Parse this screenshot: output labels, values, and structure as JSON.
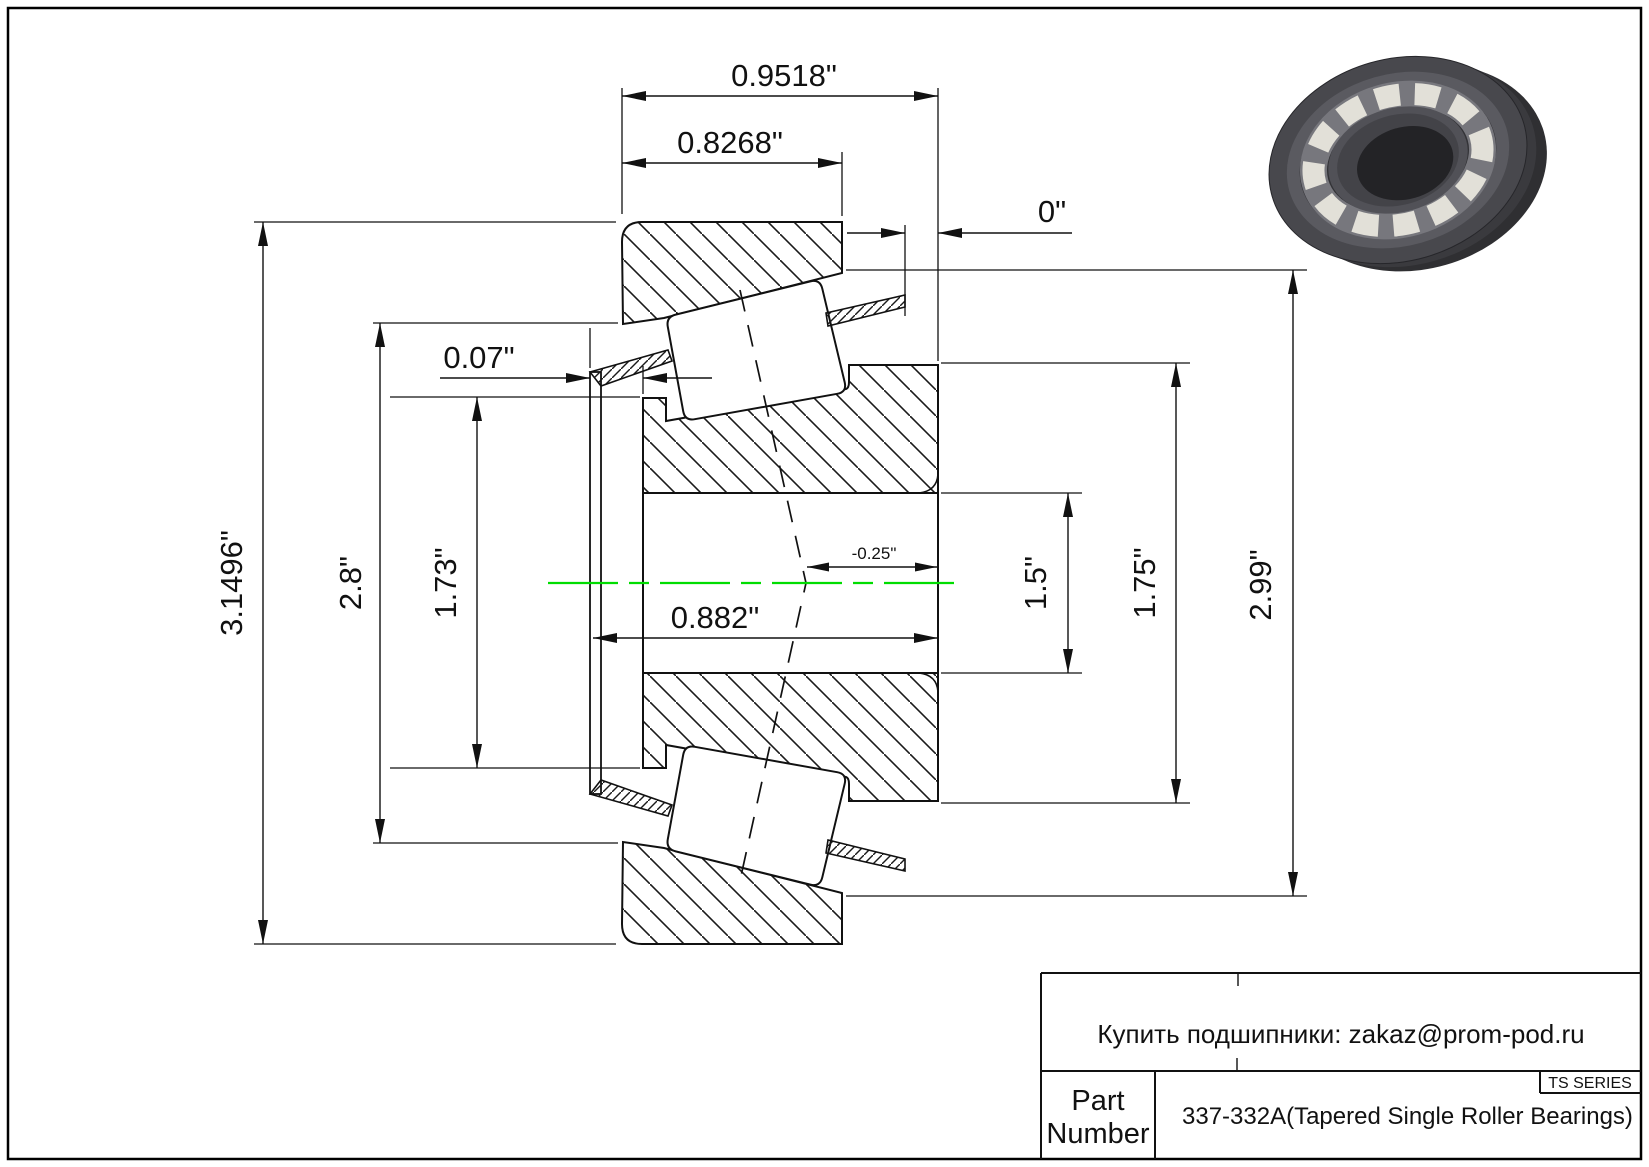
{
  "colors": {
    "centerline": "#00dd00",
    "line": "#141414",
    "background": "#ffffff"
  },
  "dims": {
    "total_width": "0.9518\"",
    "cup_width": "0.8268\"",
    "backface_standout": "0\"",
    "cage_front_standout": "0.07\"",
    "outer_diameter": "3.1496\"",
    "left_shoulder_diameter": "2.8\"",
    "cage_small_end_diameter": "1.73\"",
    "cone_width": "0.882\"",
    "apex_offset": "-0.25\"",
    "bore_diameter": "1.5\"",
    "cone_front_rib_diameter": "1.75\"",
    "race_large_diameter": "2.99\""
  },
  "title_block": {
    "contact": "Купить подшипники: zakaz@prom-pod.ru",
    "part_label_line1": "Part",
    "part_label_line2": "Number",
    "part_number": "337-332A(Tapered Single Roller Bearings)",
    "series": "TS SERIES"
  },
  "illustration": {
    "name": "tapered-roller-bearing-3d-render"
  }
}
